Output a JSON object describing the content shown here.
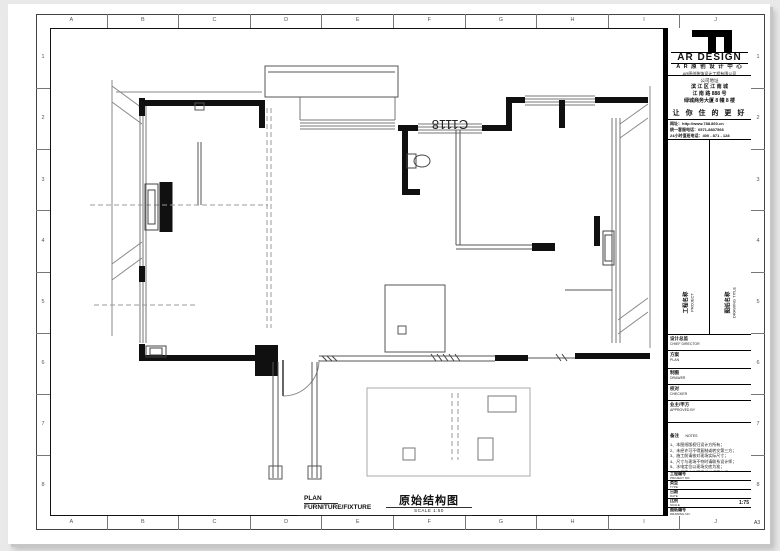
{
  "frame": {
    "grid_letters": [
      "A",
      "B",
      "C",
      "D",
      "E",
      "F",
      "G",
      "H",
      "I",
      "J"
    ],
    "grid_numbers": [
      "1",
      "2",
      "3",
      "4",
      "5",
      "6",
      "7",
      "8"
    ],
    "paper_size": "A3"
  },
  "plan": {
    "window_tag": "C1118",
    "caption": {
      "line1": "PLAN",
      "line2": "FURNITURE/FIXTURE",
      "title_cn": "原始结构图",
      "scale": "SCALE 1:50"
    }
  },
  "titleblock": {
    "brand": {
      "name": "AR DESIGN",
      "sub": "A R 原 创 设 计 中 心",
      "company": "AR原创装饰设计工程有限公司"
    },
    "address": {
      "label": "公司地址",
      "lines": [
        "滨 江 区 江 南 城",
        "江 南 路 888 号",
        "绿城商务大厦 8 幢 8 楼"
      ]
    },
    "slogan": "让 你 住 的 更 好",
    "contacts": [
      "网址：http://www.788.860.cn",
      "统一客服电话：0571-8837566",
      "24小时值班电话：400 - 871 - 128"
    ],
    "project": {
      "cn": "工程名称",
      "en": "PROJECT"
    },
    "drawing": {
      "cn": "图纸名称",
      "en": "DRAWING TITLE"
    },
    "rows": [
      {
        "cn": "设计总监",
        "en": "CHIEF DIRECTOR"
      },
      {
        "cn": "方案",
        "en": "PLAN"
      },
      {
        "cn": "制图",
        "en": "DRAWER"
      },
      {
        "cn": "校对",
        "en": "CHECKER"
      },
      {
        "cn": "业主/甲方",
        "en": "APPROVED BY"
      }
    ],
    "notes": {
      "cn": "备注",
      "en": "NOTES",
      "lines": [
        "1、本图纸版权归设计方所有；",
        "2、未经许可不得复制或转交第三方；",
        "3、施工前请核对现场实际尺寸；",
        "4、尺寸与现场不符时请联系设计师；",
        "5、水电定位以现场交底为准；",
        "6、未尽事宜按国家相关规范执行。"
      ]
    },
    "bottom_rows": [
      {
        "cn": "工程编号",
        "en": "PROJECT NO.",
        "value": ""
      },
      {
        "cn": "类型",
        "en": "TYPE",
        "value": ""
      },
      {
        "cn": "日期",
        "en": "DATE",
        "value": ""
      },
      {
        "cn": "比例",
        "en": "SCALE",
        "value": "1:75"
      },
      {
        "cn": "图纸编号",
        "en": "DRAWING NO.",
        "value": ""
      }
    ]
  }
}
